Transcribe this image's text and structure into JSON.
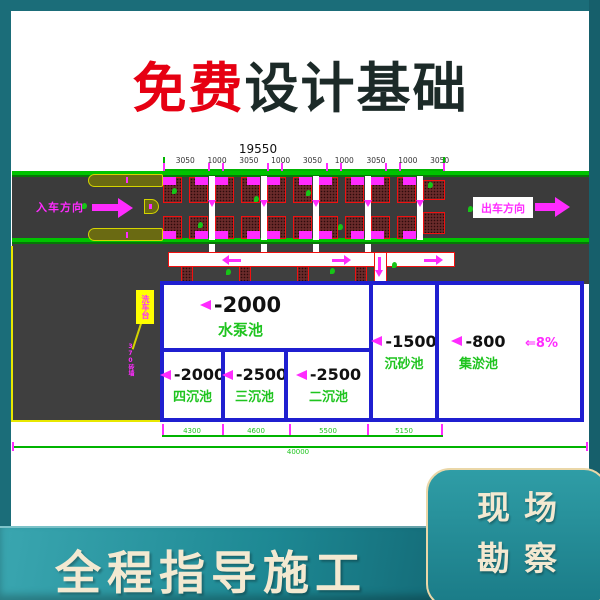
{
  "banner": {
    "highlight": "免费",
    "rest": "设计基础"
  },
  "drawing": {
    "total_width_label": "19550",
    "segment_labels": [
      "3050",
      "1000",
      "3050",
      "1000",
      "3050",
      "1000",
      "3050",
      "1000",
      "3050"
    ],
    "entry_label": "入车方向",
    "exit_label": "出车方向",
    "platform_callout": "洗车台",
    "platform_note": "370砖墙",
    "slope_label": "⇐8%",
    "pools": {
      "pump": {
        "depth": "-2000",
        "name": "水泵池"
      },
      "fourth": {
        "depth": "-2000",
        "name": "四沉池"
      },
      "third": {
        "depth": "-2500",
        "name": "三沉池"
      },
      "second": {
        "depth": "-2500",
        "name": "二沉池"
      },
      "sand": {
        "depth": "-1500",
        "name": "沉砂池"
      },
      "silt": {
        "depth": "-800",
        "name": "集淤池"
      }
    },
    "bottom_dims": [
      "4300",
      "4600",
      "5500",
      "5150"
    ],
    "overall_dim": "40000"
  },
  "footer": {
    "slogan": "全程指导施工",
    "badge_line1": "现场",
    "badge_line2": "勘察"
  },
  "colors": {
    "frame_teal": "#1b6d79",
    "band_teal_dark": "#0c5260",
    "badge_border": "#ead7a8",
    "cream_text": "#f3e9d1",
    "title_red": "#e60012",
    "title_dark": "#1c2a28",
    "cad_green": "#00c300",
    "cad_magenta": "#ff2bff",
    "cad_blue": "#1f1fd0",
    "cad_red": "#f21010",
    "road_gray": "#3b3b3b",
    "label_green": "#1fc41f",
    "olive": "#6a6a12",
    "yellow": "#ffff00"
  }
}
